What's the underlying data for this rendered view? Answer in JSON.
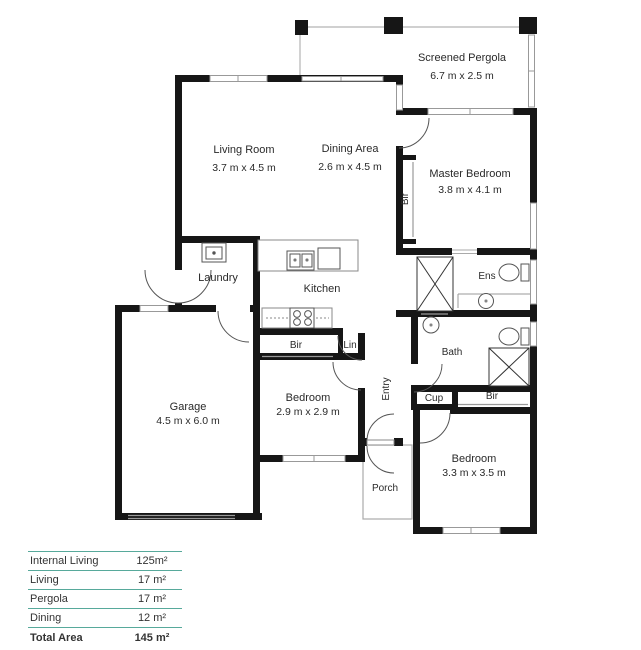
{
  "rooms": {
    "pergola": {
      "name": "Screened Pergola",
      "dims": "6.7 m x 2.5 m"
    },
    "living": {
      "name": "Living Room",
      "dims": "3.7 m x 4.5 m"
    },
    "dining": {
      "name": "Dining Area",
      "dims": "2.6 m x 4.5 m"
    },
    "master": {
      "name": "Master Bedroom",
      "dims": "3.8 m x 4.1 m"
    },
    "garage": {
      "name": "Garage",
      "dims": "4.5 m x 6.0 m"
    },
    "bedroom2": {
      "name": "Bedroom",
      "dims": "2.9 m x 2.9 m"
    },
    "bedroom3": {
      "name": "Bedroom",
      "dims": "3.3 m x 3.5 m"
    },
    "laundry": "Laundry",
    "kitchen": "Kitchen",
    "ens": "Ens",
    "bath": "Bath",
    "entry": "Entry",
    "porch": "Porch",
    "cup": "Cup",
    "lin": "Lin",
    "bir": "Bir"
  },
  "area_table": {
    "rows": [
      {
        "label": "Internal Living",
        "value": "125m²"
      },
      {
        "label": "Living",
        "value": "17 m²"
      },
      {
        "label": "Pergola",
        "value": "17 m²"
      },
      {
        "label": "Dining",
        "value": "12 m²"
      }
    ],
    "total_label": "Total Area",
    "total_value": "145 m²"
  },
  "colors": {
    "wall": "#161616",
    "table_line": "#57a99b"
  }
}
